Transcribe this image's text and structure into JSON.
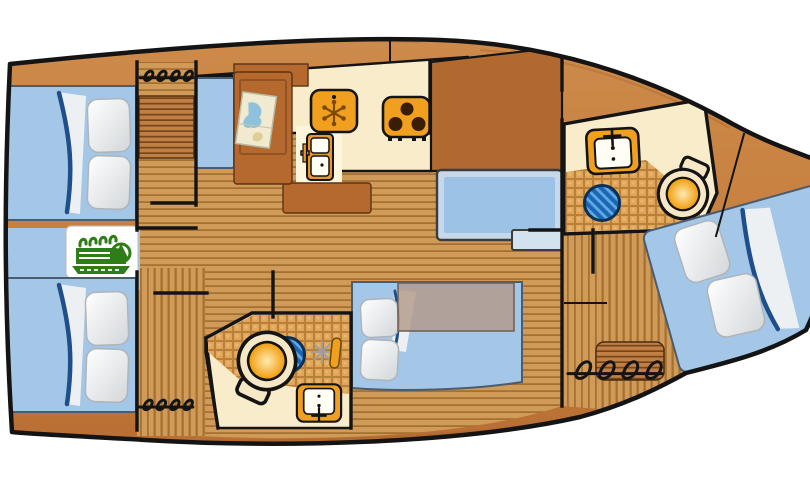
{
  "page": {
    "background": "#ffffff"
  },
  "diagram": {
    "kind": "sailboat-interior-layout",
    "view": "top-down",
    "orientation": "bow-right"
  },
  "colors": {
    "background": "#ffffff",
    "outline": "#141414",
    "deck_wood": "#c6803f",
    "deck_wood_dark": "#b06a30",
    "floor_base": "#d09a58",
    "floor_line": "#9e6a2c",
    "furniture_wood": "#b5692e",
    "steps_base": "#c07f45",
    "steps_line": "#6f4214",
    "cream": "#f8ecca",
    "cream_bright": "#fdf6dd",
    "tile_base": "#e0a558",
    "tile_line": "#b9803a",
    "bed_blue": "#a4c7e8",
    "seat_border": "#c6d9ea",
    "seat_blue": "#9cc2e5",
    "blanket_navy": "#1f4e8c",
    "appliance_orange": "#f0a01e",
    "burner_dark": "#3a1d05",
    "drain_blue": "#1a67b5",
    "drain_light": "#62a9e4",
    "drain_border": "#0a3055",
    "toilet_rim": "#f6e7c6",
    "bowl_orange": "#f09a05",
    "engine_green": "#2e7d17",
    "map_paper": "#f0ead0",
    "map_water": "#8ec2dc",
    "map_land": "#dfce96",
    "table_translucent": "#b29a89"
  },
  "rooms": [
    "aft-cabin-port",
    "aft-cabin-starboard",
    "engine-compartment",
    "companionway",
    "nav-station",
    "galley",
    "saloon",
    "aft-head",
    "fwd-head",
    "fwd-cabin-v-berth"
  ],
  "icons": [
    "hatch-coil-icon",
    "companionway-steps-icon",
    "engine-icon",
    "chart-map-icon",
    "fridge-freezer-icon",
    "stove-icon",
    "refrigerator-icon",
    "sink-icon",
    "shower-drain-icon",
    "toilet-icon",
    "shower-spray-icon"
  ],
  "furniture": [
    "double-berth",
    "v-berth",
    "pillows",
    "blanket",
    "settee",
    "saloon-table",
    "nav-seat",
    "fwd-seat",
    "bow-steps"
  ]
}
